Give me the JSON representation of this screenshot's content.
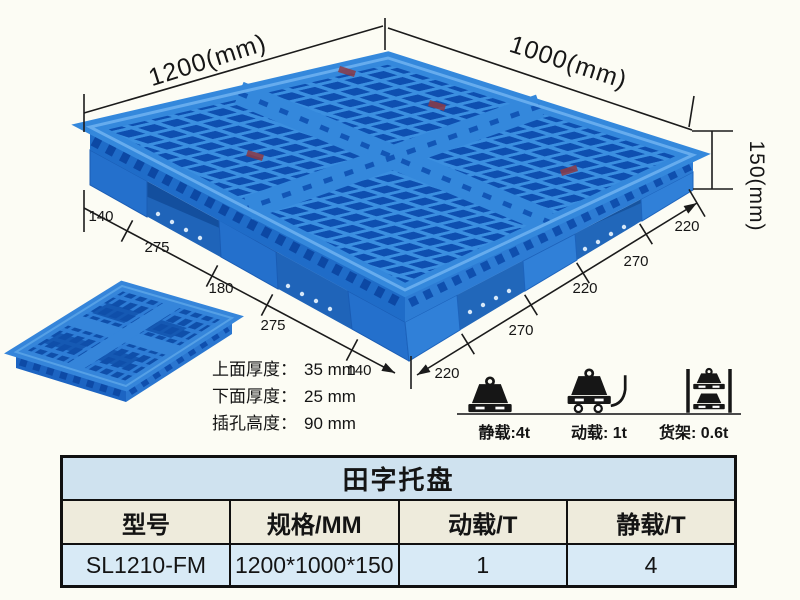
{
  "colors": {
    "pallet_blue": "#2f82da",
    "pallet_light": "#5fa8ec",
    "pallet_dark_hole": "#0e4fb0",
    "side_left": "#1f6cc8",
    "side_right": "#2d7cd4",
    "under_dark": "#134f9e",
    "table_blue": "#cfe2ef",
    "table_data_blue": "#d8eaf6",
    "header_cream": "#eeebdc",
    "line_black": "#141414"
  },
  "dimensions": {
    "width_label": "1200(mm)",
    "depth_label": "1000(mm)",
    "height_label": "150(mm)",
    "left_chain": [
      "140",
      "275",
      "180",
      "275",
      "140"
    ],
    "right_chain": [
      "220",
      "270",
      "220",
      "270",
      "220"
    ]
  },
  "notes": [
    {
      "label": "上面厚度：",
      "value": "35 mm"
    },
    {
      "label": "下面厚度：",
      "value": "25 mm"
    },
    {
      "label": "插孔高度：",
      "value": "90 mm"
    }
  ],
  "load_ratings": [
    {
      "icon": "static-load-icon",
      "label": "静载:4t"
    },
    {
      "icon": "dynamic-load-icon",
      "label": "动载: 1t"
    },
    {
      "icon": "rack-load-icon",
      "label": "货架: 0.6t"
    }
  ],
  "spec_table": {
    "title": "田字托盘",
    "headers": [
      "型号",
      "规格/MM",
      "动载/T",
      "静载/T"
    ],
    "rows": [
      [
        "SL1210-FM",
        "1200*1000*150",
        "1",
        "4"
      ]
    ]
  }
}
